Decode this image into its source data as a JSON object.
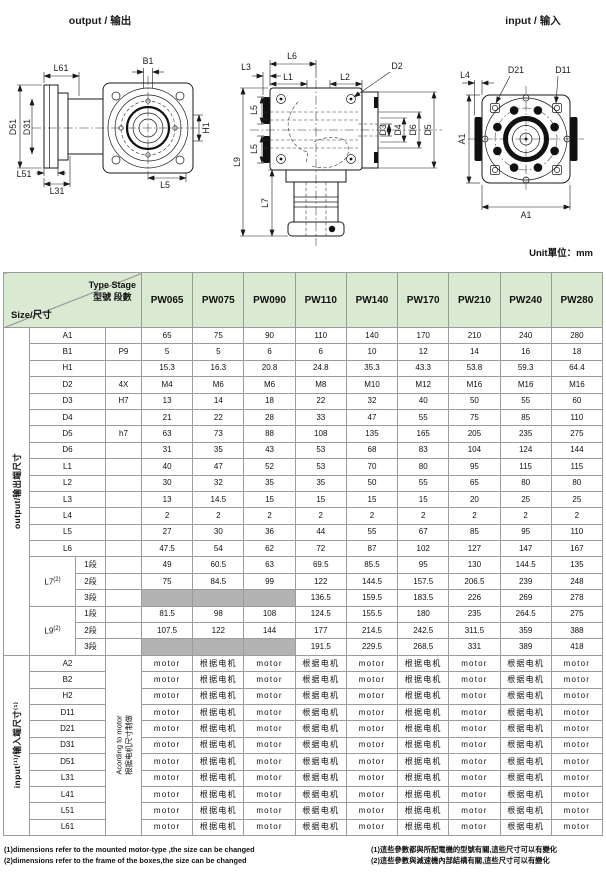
{
  "drawings": {
    "output_view": {
      "title": "output / 输出",
      "labels": {
        "l61": "L61",
        "b1": "B1",
        "d51": "D51",
        "d31": "D31",
        "l51": "L51",
        "l31": "L31",
        "l5": "L5",
        "h1": "H1"
      }
    },
    "front_view": {
      "labels": {
        "l6": "L6",
        "l3": "L3",
        "l1": "L1",
        "l2": "L2",
        "d2": "D2",
        "l5_upper": "L5",
        "l5_lower": "L5",
        "l9": "L9",
        "l7": "L7",
        "d3": "D3",
        "d4": "D4",
        "d6": "D6",
        "d5": "D5"
      }
    },
    "input_view": {
      "title": "input / 输入",
      "labels": {
        "l4": "L4",
        "d21": "D21",
        "d11": "D11",
        "a1_side": "A1",
        "a1_bottom": "A1"
      }
    }
  },
  "table": {
    "unit_label": "Unit單位：mm",
    "header": {
      "type_stage_en": "Type Stage",
      "type_stage_zh": "型號 段數",
      "size_label": "Size/尺寸",
      "columns": [
        "PW065",
        "PW075",
        "PW090",
        "PW110",
        "PW140",
        "PW170",
        "PW210",
        "PW240",
        "PW280"
      ]
    },
    "output_section": {
      "group_label": "output/输出端尺寸",
      "rows": [
        {
          "name": "A1",
          "tol": "",
          "values": [
            "65",
            "75",
            "90",
            "110",
            "140",
            "170",
            "210",
            "240",
            "280"
          ]
        },
        {
          "name": "B1",
          "tol": "P9",
          "values": [
            "5",
            "5",
            "6",
            "6",
            "10",
            "12",
            "14",
            "16",
            "18"
          ]
        },
        {
          "name": "H1",
          "tol": "",
          "values": [
            "15.3",
            "16.3",
            "20.8",
            "24.8",
            "35.3",
            "43.3",
            "53.8",
            "59.3",
            "64.4"
          ]
        },
        {
          "name": "D2",
          "tol": "4X",
          "values": [
            "M4",
            "M6",
            "M6",
            "M8",
            "M10",
            "M12",
            "M16",
            "M16",
            "M16"
          ]
        },
        {
          "name": "D3",
          "tol": "H7",
          "values": [
            "13",
            "14",
            "18",
            "22",
            "32",
            "40",
            "50",
            "55",
            "60"
          ]
        },
        {
          "name": "D4",
          "tol": "",
          "values": [
            "21",
            "22",
            "28",
            "33",
            "47",
            "55",
            "75",
            "85",
            "110"
          ]
        },
        {
          "name": "D5",
          "tol": "h7",
          "values": [
            "63",
            "73",
            "88",
            "108",
            "135",
            "165",
            "205",
            "235",
            "275"
          ]
        },
        {
          "name": "D6",
          "tol": "",
          "values": [
            "31",
            "35",
            "43",
            "53",
            "68",
            "83",
            "104",
            "124",
            "144"
          ]
        },
        {
          "name": "L1",
          "tol": "",
          "values": [
            "40",
            "47",
            "52",
            "53",
            "70",
            "80",
            "95",
            "115",
            "115"
          ]
        },
        {
          "name": "L2",
          "tol": "",
          "values": [
            "30",
            "32",
            "35",
            "35",
            "50",
            "55",
            "65",
            "80",
            "80"
          ]
        },
        {
          "name": "L3",
          "tol": "",
          "values": [
            "13",
            "14.5",
            "15",
            "15",
            "15",
            "15",
            "20",
            "25",
            "25"
          ]
        },
        {
          "name": "L4",
          "tol": "",
          "values": [
            "2",
            "2",
            "2",
            "2",
            "2",
            "2",
            "2",
            "2",
            "2"
          ]
        },
        {
          "name": "L5",
          "tol": "",
          "values": [
            "27",
            "30",
            "36",
            "44",
            "55",
            "67",
            "85",
            "95",
            "110"
          ]
        },
        {
          "name": "L6",
          "tol": "",
          "values": [
            "47.5",
            "54",
            "62",
            "72",
            "87",
            "102",
            "127",
            "147",
            "167"
          ]
        }
      ],
      "groups": [
        {
          "name": "L7",
          "sup": "(2)",
          "subrows": [
            {
              "label": "1段",
              "values": [
                "49",
                "60.5",
                "63",
                "69.5",
                "85.5",
                "95",
                "130",
                "144.5",
                "135"
              ]
            },
            {
              "label": "2段",
              "values": [
                "75",
                "84.5",
                "99",
                "122",
                "144.5",
                "157.5",
                "206.5",
                "239",
                "248"
              ]
            },
            {
              "label": "3段",
              "values": [
                "",
                "",
                "",
                "136.5",
                "159.5",
                "183.5",
                "226",
                "269",
                "278"
              ]
            }
          ]
        },
        {
          "name": "L9",
          "sup": "(2)",
          "subrows": [
            {
              "label": "1段",
              "values": [
                "81.5",
                "98",
                "108",
                "124.5",
                "155.5",
                "180",
                "235",
                "264.5",
                "275"
              ]
            },
            {
              "label": "2段",
              "values": [
                "107.5",
                "122",
                "144",
                "177",
                "214.5",
                "242.5",
                "311.5",
                "359",
                "388"
              ]
            },
            {
              "label": "3段",
              "values": [
                "",
                "",
                "",
                "191.5",
                "229.5",
                "268.5",
                "331",
                "389",
                "418"
              ]
            }
          ]
        }
      ]
    },
    "input_section": {
      "group_label": "input⁽¹⁾/输入端尺寸⁽¹⁾",
      "stage_note_en": "Acording to motor",
      "stage_note_zh": "根据电机尺寸制做",
      "row_names": [
        "A2",
        "B2",
        "H2",
        "D11",
        "D21",
        "D31",
        "D51",
        "L31",
        "L41",
        "L51",
        "L61"
      ],
      "row_values": [
        "motor",
        "根据电机",
        "motor",
        "根据电机",
        "motor",
        "根据电机",
        "motor",
        "根据电机",
        "motor"
      ]
    }
  },
  "footnotes": {
    "en": [
      "(1)dimensions refer to the mounted motor-type ,the size can be changed",
      "(2)dimensions refer to the frame of the boxes,the size can be changed"
    ],
    "zh": [
      "(1)這些參數都與所配電機的型號有關,這些尺寸可以有變化",
      "(2)這些參數與減速機內部結構有關,這些尺寸可以有變化"
    ]
  }
}
